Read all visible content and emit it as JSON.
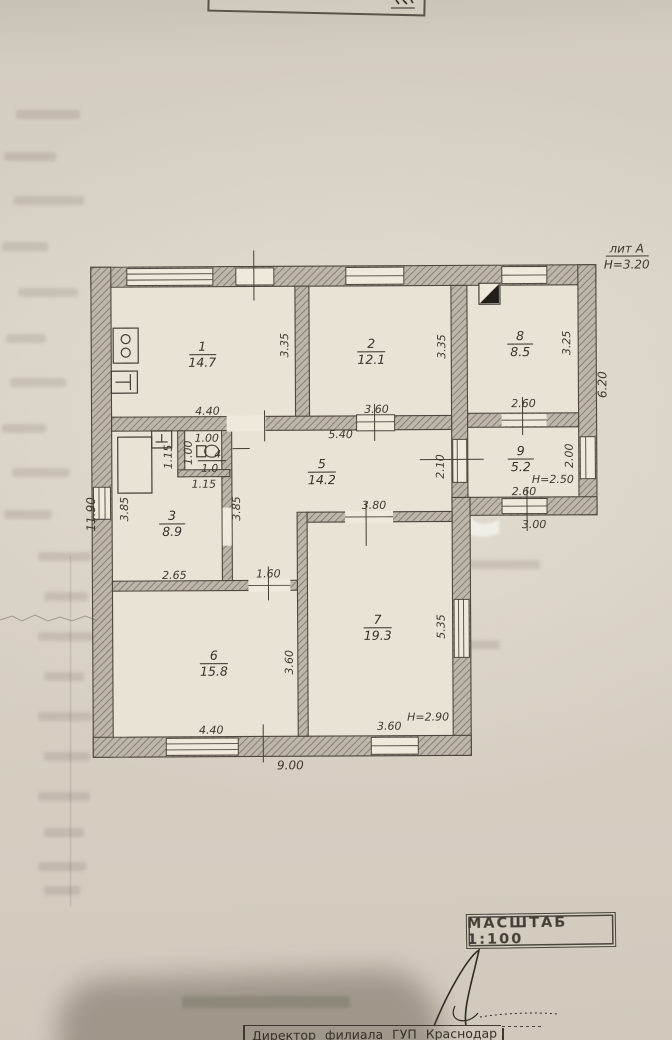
{
  "colors": {
    "paper": "#d6cfc3",
    "ink": "#3e382f",
    "wall_fill": "#bdb7ab",
    "room_fill": "#e9e3d6"
  },
  "watermark": {
    "text": "аякс"
  },
  "plan": {
    "litera": "лит А",
    "building_height": "Н=3.20",
    "rooms": [
      {
        "number": "1",
        "area": "14.7"
      },
      {
        "number": "2",
        "area": "12.1"
      },
      {
        "number": "3",
        "area": "8.9"
      },
      {
        "number": "4",
        "area": "1.0"
      },
      {
        "number": "5",
        "area": "14.2"
      },
      {
        "number": "6",
        "area": "15.8"
      },
      {
        "number": "7",
        "area": "19.3"
      },
      {
        "number": "8",
        "area": "8.5"
      },
      {
        "number": "9",
        "area": "5.2"
      }
    ],
    "dims": {
      "top440": "4.40",
      "v335a": "3.35",
      "v335b": "3.35",
      "top360": "3.60",
      "d540": "5.40",
      "v325": "3.25",
      "v620": "6.20",
      "d260a": "2.60",
      "v200": "2.00",
      "h250": "Н=2.50",
      "d260b": "2.60",
      "d300": "3.00",
      "v210": "2.10",
      "d100a": "1.00",
      "v100b": "1.00",
      "v115a": "1.15",
      "d115b": "1.15",
      "v385a": "3.85",
      "v385b": "3.85",
      "v1190": "11.90",
      "d265": "2.65",
      "d160": "1.60",
      "d380": "3.80",
      "v535": "5.35",
      "v360r": "3.60",
      "b440": "4.40",
      "b360": "3.60",
      "h290": "Н=2.90",
      "b900": "9.00"
    }
  },
  "stamp": {
    "scale_label": "МАСШТАБ 1:100"
  },
  "footer": {
    "signature_title": "Директор филиала ГУП Краснодар"
  }
}
